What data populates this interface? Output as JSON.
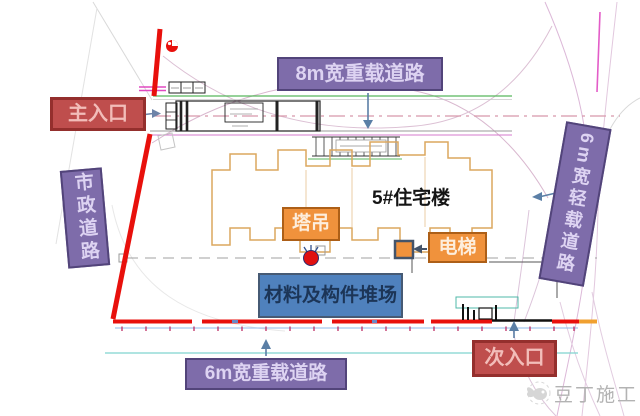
{
  "plan": {
    "roads": {
      "top_heavy": {
        "label": "8m宽重载道路"
      },
      "bottom_heavy": {
        "label": "6m宽重载道路"
      },
      "municipal": {
        "label": "市政道路"
      },
      "east_light": {
        "label": "6m宽轻载道路"
      }
    },
    "entrances": {
      "main": {
        "label": "主入口"
      },
      "secondary": {
        "label": "次入口"
      }
    },
    "structures": {
      "building": {
        "label": "5#住宅楼"
      },
      "tower_crane": {
        "label": "塔吊"
      },
      "elevator": {
        "label": "电梯"
      },
      "materials_yard": {
        "label": "材料及构件堆场"
      }
    },
    "watermark": {
      "text": "豆丁施工"
    },
    "colors": {
      "road_label_purple": "#7e6caa",
      "entrance_label_red": "#bf4e4d",
      "facility_label_orange": "#f0923c",
      "yard_label_blue": "#4f81bd",
      "site_boundary_red": "#e8100c",
      "arrow_blue": "#5b7fa6",
      "building_outline_orange": "#dca75f"
    }
  }
}
